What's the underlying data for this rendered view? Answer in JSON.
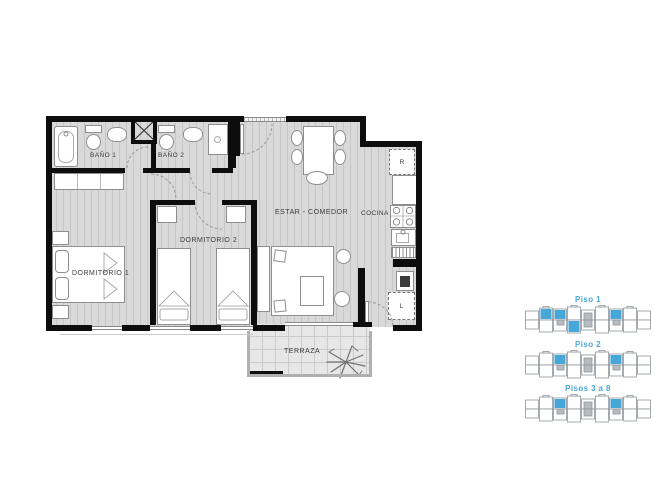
{
  "plan": {
    "rooms": {
      "bano1": "BAÑO 1",
      "bano2": "BAÑO 2",
      "dormitorio1": "DORMITORIO 1",
      "dormitorio2": "DORMITORIO 2",
      "estar_comedor": "ESTAR  -  COMEDOR",
      "cocina": "COCINA",
      "terraza": "TERRAZA"
    },
    "appliances": {
      "refrigerator": "R",
      "laundry": "L"
    }
  },
  "floor_key": {
    "accent_color": "#47a7d8",
    "outline_color": "#8f969c",
    "core_color": "#b6bcc1",
    "items": [
      {
        "label": "Piso 1",
        "highlights": {
          "top": [
            1,
            2,
            6
          ],
          "bottom": [
            3
          ]
        }
      },
      {
        "label": "Piso 2",
        "highlights": {
          "top": [
            2,
            6
          ],
          "bottom": []
        }
      },
      {
        "label": "Pisos 3 a 8",
        "highlights": {
          "top": [
            2,
            6
          ],
          "bottom": []
        }
      }
    ]
  }
}
